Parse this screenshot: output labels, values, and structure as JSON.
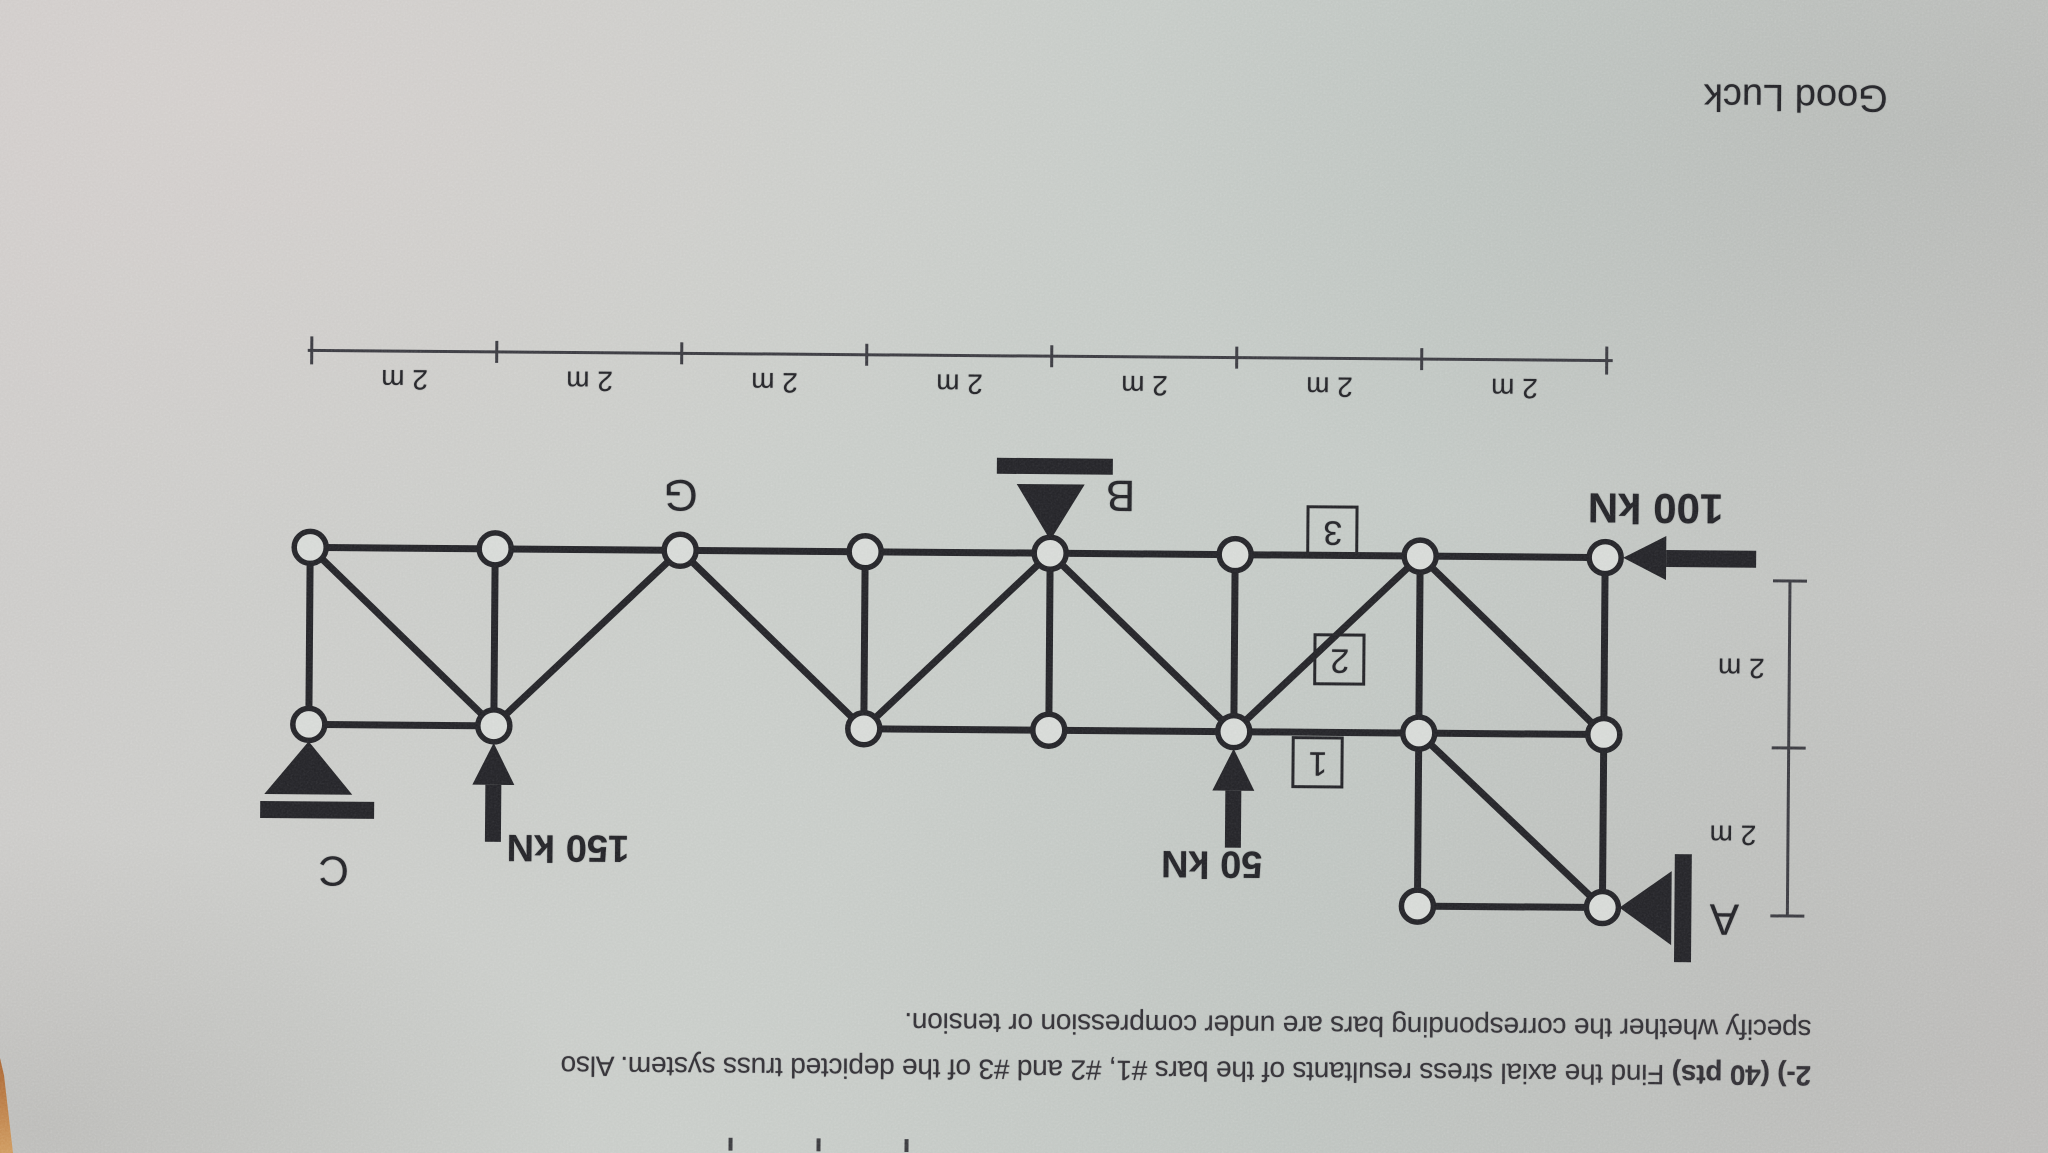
{
  "photo": {
    "description": "photo of an exam sheet lying rotated 180 degrees (upside-down)",
    "ink_color": "#232327",
    "dim_color": "#3a3a40",
    "node_fill": "#d6d9d6",
    "desk_color": "#a96331",
    "edge_mark_xs": [
      733,
      821,
      909
    ]
  },
  "problem": {
    "number_bold": "2-) (40 pts)",
    "line1_rest": " Find the axial stress resultants of the bars #1, #2 and #3 of the depicted truss system. Also",
    "line2": "specify whether the corresponding bars are under compression or tension.",
    "good_luck": "Good Luck"
  },
  "truss": {
    "node_radius": 16,
    "member_width": 7,
    "nodes": [
      [
        310,
        553
      ],
      [
        495,
        553
      ],
      [
        680,
        553
      ],
      [
        865,
        553
      ],
      [
        1050,
        553
      ],
      [
        1235,
        553
      ],
      [
        1420,
        553
      ],
      [
        1605,
        553
      ],
      [
        310,
        730
      ],
      [
        495,
        730
      ],
      [
        865,
        730
      ],
      [
        1050,
        730
      ],
      [
        1235,
        730
      ],
      [
        1420,
        730
      ],
      [
        1605,
        730
      ],
      [
        1420,
        903
      ],
      [
        1605,
        903
      ]
    ],
    "members": [
      [
        310,
        553,
        1605,
        553
      ],
      [
        310,
        730,
        495,
        730
      ],
      [
        865,
        730,
        1605,
        730
      ],
      [
        1420,
        903,
        1605,
        903
      ],
      [
        310,
        553,
        310,
        730
      ],
      [
        495,
        553,
        495,
        730
      ],
      [
        865,
        553,
        865,
        730
      ],
      [
        1050,
        553,
        1050,
        730
      ],
      [
        1235,
        553,
        1235,
        730
      ],
      [
        1420,
        553,
        1420,
        730
      ],
      [
        1605,
        553,
        1605,
        730
      ],
      [
        1420,
        730,
        1420,
        903
      ],
      [
        1605,
        730,
        1605,
        903
      ],
      [
        310,
        553,
        495,
        730
      ],
      [
        680,
        553,
        495,
        730
      ],
      [
        680,
        553,
        865,
        730
      ],
      [
        1050,
        553,
        865,
        730
      ],
      [
        1050,
        553,
        1235,
        730
      ],
      [
        1420,
        553,
        1235,
        730
      ],
      [
        1420,
        553,
        1605,
        730
      ],
      [
        1420,
        730,
        1605,
        903
      ]
    ],
    "joint_label": {
      "text": "G",
      "x": 680,
      "y": 497,
      "size": 44
    },
    "supports": [
      {
        "label": "B",
        "tri": "1050,540 1016,484 1084,484",
        "bar": [
          996,
          458,
          116,
          16
        ],
        "label_x": 1120,
        "label_y": 494,
        "size": 44
      },
      {
        "label": "C",
        "tri": "310,747 266,800 354,800",
        "bar": [
          262,
          807,
          114,
          17
        ],
        "label_x": 336,
        "label_y": 876,
        "size": 42
      },
      {
        "label": "A",
        "tri": "1622,903 1674,866 1674,940",
        "bar": [
          1677,
          849,
          17,
          108
        ],
        "label_x": 1727,
        "label_y": 913,
        "size": 44
      }
    ],
    "loads": [
      {
        "label": "100 kN",
        "head": "1623,553 1666,531 1666,575",
        "shaft": [
          1666,
          545,
          90,
          17
        ],
        "label_x": 1655,
        "label_y": 503,
        "size": 42
      },
      {
        "label": "150 kN",
        "head": "495,747 474,789 516,789",
        "shaft": [
          487,
          789,
          16,
          57
        ],
        "label_x": 570,
        "label_y": 851,
        "size": 38
      },
      {
        "label": "50 kN",
        "head": "1235,747 1214,789 1256,789",
        "shaft": [
          1227,
          789,
          16,
          57
        ],
        "label_x": 1214,
        "label_y": 862,
        "size": 38
      }
    ],
    "bar_markers": [
      {
        "label": "3",
        "cx": 1332,
        "cy": 529
      },
      {
        "label": "2",
        "cx": 1340,
        "cy": 657
      },
      {
        "label": "1",
        "cx": 1319,
        "cy": 760
      }
    ]
  },
  "dimensions": {
    "horizontal": {
      "y": 356,
      "ticks_x": [
        310,
        495,
        680,
        865,
        1050,
        1235,
        1420,
        1605
      ],
      "labels": [
        "2 m",
        "2 m",
        "2 m",
        "2 m",
        "2 m",
        "2 m",
        "2 m"
      ],
      "label_y": 384
    },
    "vertical": {
      "x": 1790,
      "ticks_y": [
        575,
        742,
        910
      ],
      "labels": [
        "2 m",
        "2 m"
      ],
      "label_pos": [
        [
          1742,
          662
        ],
        [
          1735,
          829
        ]
      ]
    }
  }
}
